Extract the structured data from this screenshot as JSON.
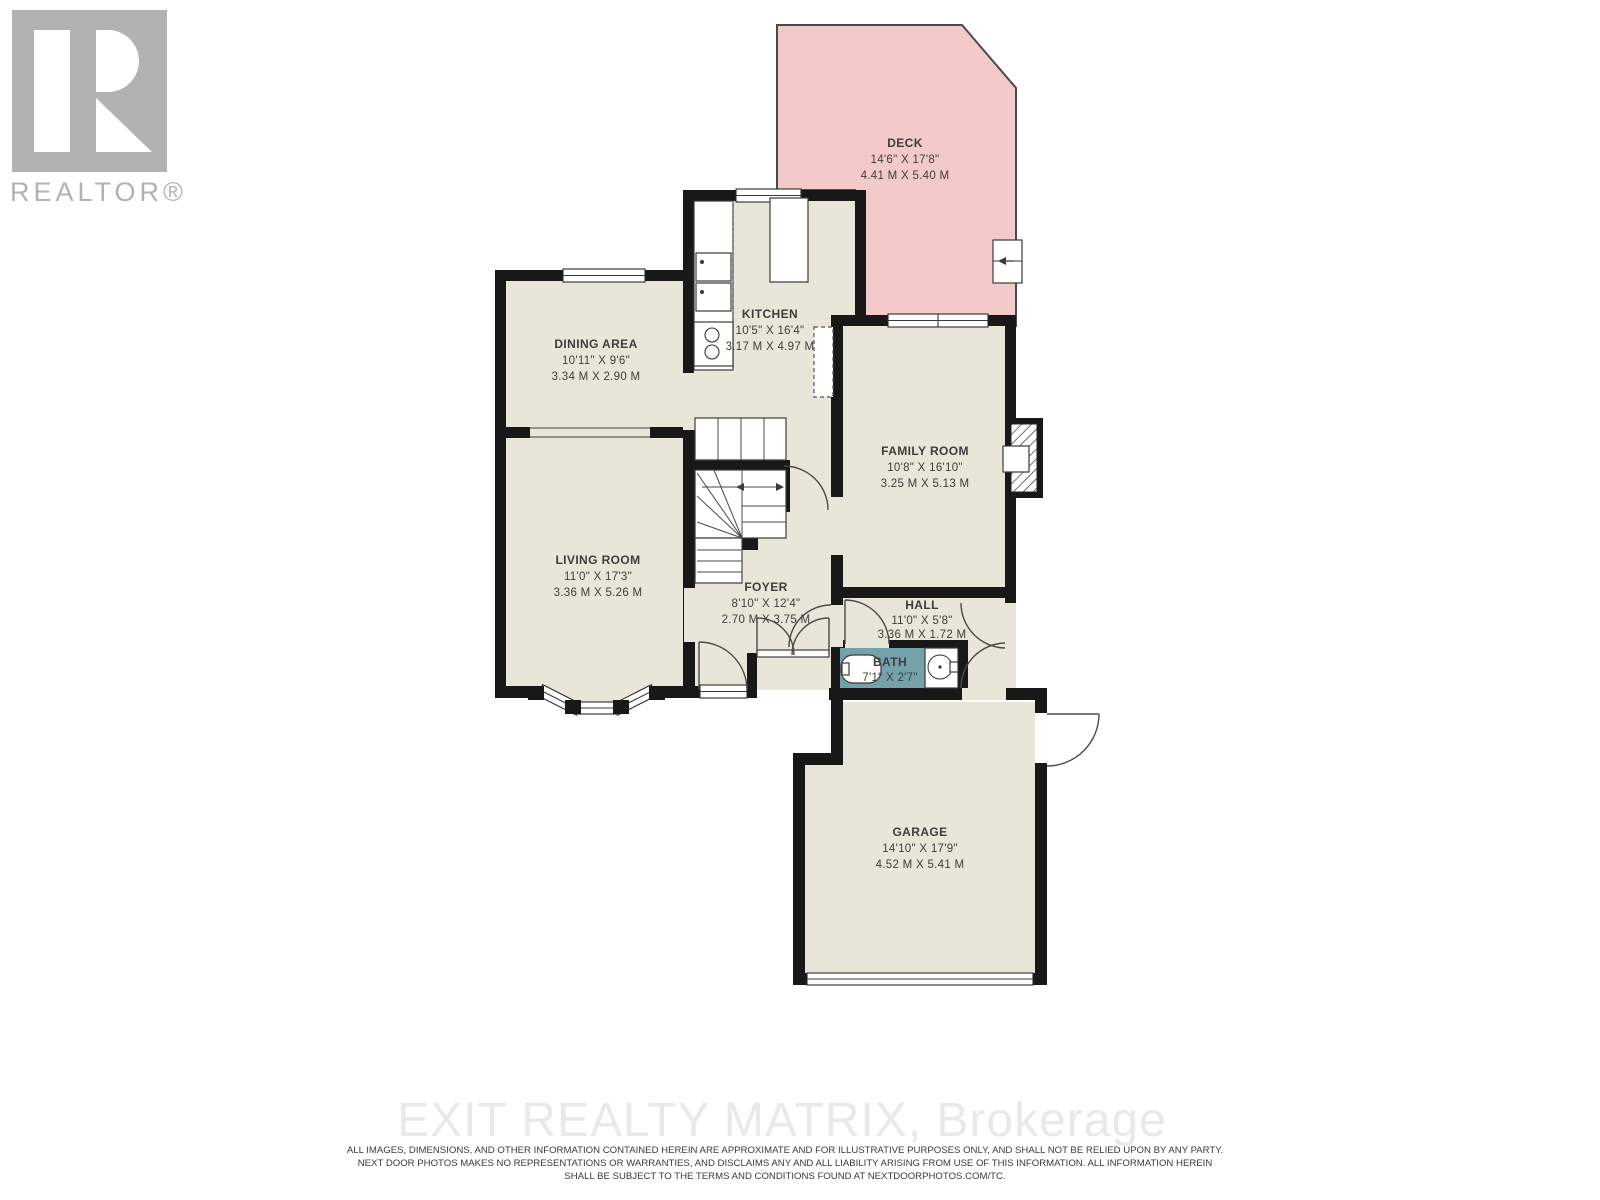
{
  "logo": {
    "text": "REALTOR®"
  },
  "rooms": {
    "deck": {
      "name": "DECK",
      "imperial": "14'6\" X 17'8\"",
      "metric": "4.41 M X 5.40 M"
    },
    "kitchen": {
      "name": "KITCHEN",
      "imperial": "10'5\" X 16'4\"",
      "metric": "3.17 M X 4.97 M"
    },
    "dining": {
      "name": "DINING AREA",
      "imperial": "10'11\" X 9'6\"",
      "metric": "3.34 M X 2.90 M"
    },
    "family": {
      "name": "FAMILY ROOM",
      "imperial": "10'8\" X 16'10\"",
      "metric": "3.25 M X 5.13 M"
    },
    "living": {
      "name": "LIVING ROOM",
      "imperial": "11'0\" X 17'3\"",
      "metric": "3.36 M X 5.26 M"
    },
    "foyer": {
      "name": "FOYER",
      "imperial": "8'10\" X 12'4\"",
      "metric": "2.70 M X 3.75 M"
    },
    "hall": {
      "name": "HALL",
      "imperial": "11'0\" X 5'8\"",
      "metric": "3.36 M X 1.72 M"
    },
    "bath": {
      "name": "BATH",
      "imperial": "7'1\" X 2'7\"",
      "metric": ""
    },
    "garage": {
      "name": "GARAGE",
      "imperial": "14'10\" X 17'9\"",
      "metric": "4.52 M X 5.41 M"
    }
  },
  "watermark": {
    "text": "EXIT REALTY MATRIX, Brokerage"
  },
  "disclaimer": {
    "line1": "ALL IMAGES, DIMENSIONS, AND OTHER INFORMATION CONTAINED HEREIN ARE APPROXIMATE AND FOR ILLUSTRATIVE PURPOSES ONLY, AND SHALL NOT BE RELIED UPON BY ANY PARTY.",
    "line2": "NEXT DOOR PHOTOS MAKES NO REPRESENTATIONS OR WARRANTIES, AND DISCLAIMS ANY AND ALL LIABILITY ARISING FROM USE OF THIS INFORMATION. ALL INFORMATION HEREIN",
    "line3": "SHALL BE SUBJECT TO THE TERMS AND CONDITIONS FOUND AT NEXTDOORPHOTOS.COM/TC."
  },
  "colors": {
    "wall": "#181818",
    "floor": "#e8e6d8",
    "deck": "#f3cac9",
    "bath": "#74a2aa",
    "logo_gray": "#b3b2b2",
    "watermark": "#e9e9e9",
    "label_text": "#3d3d3d",
    "line": "#4a4a4a"
  }
}
